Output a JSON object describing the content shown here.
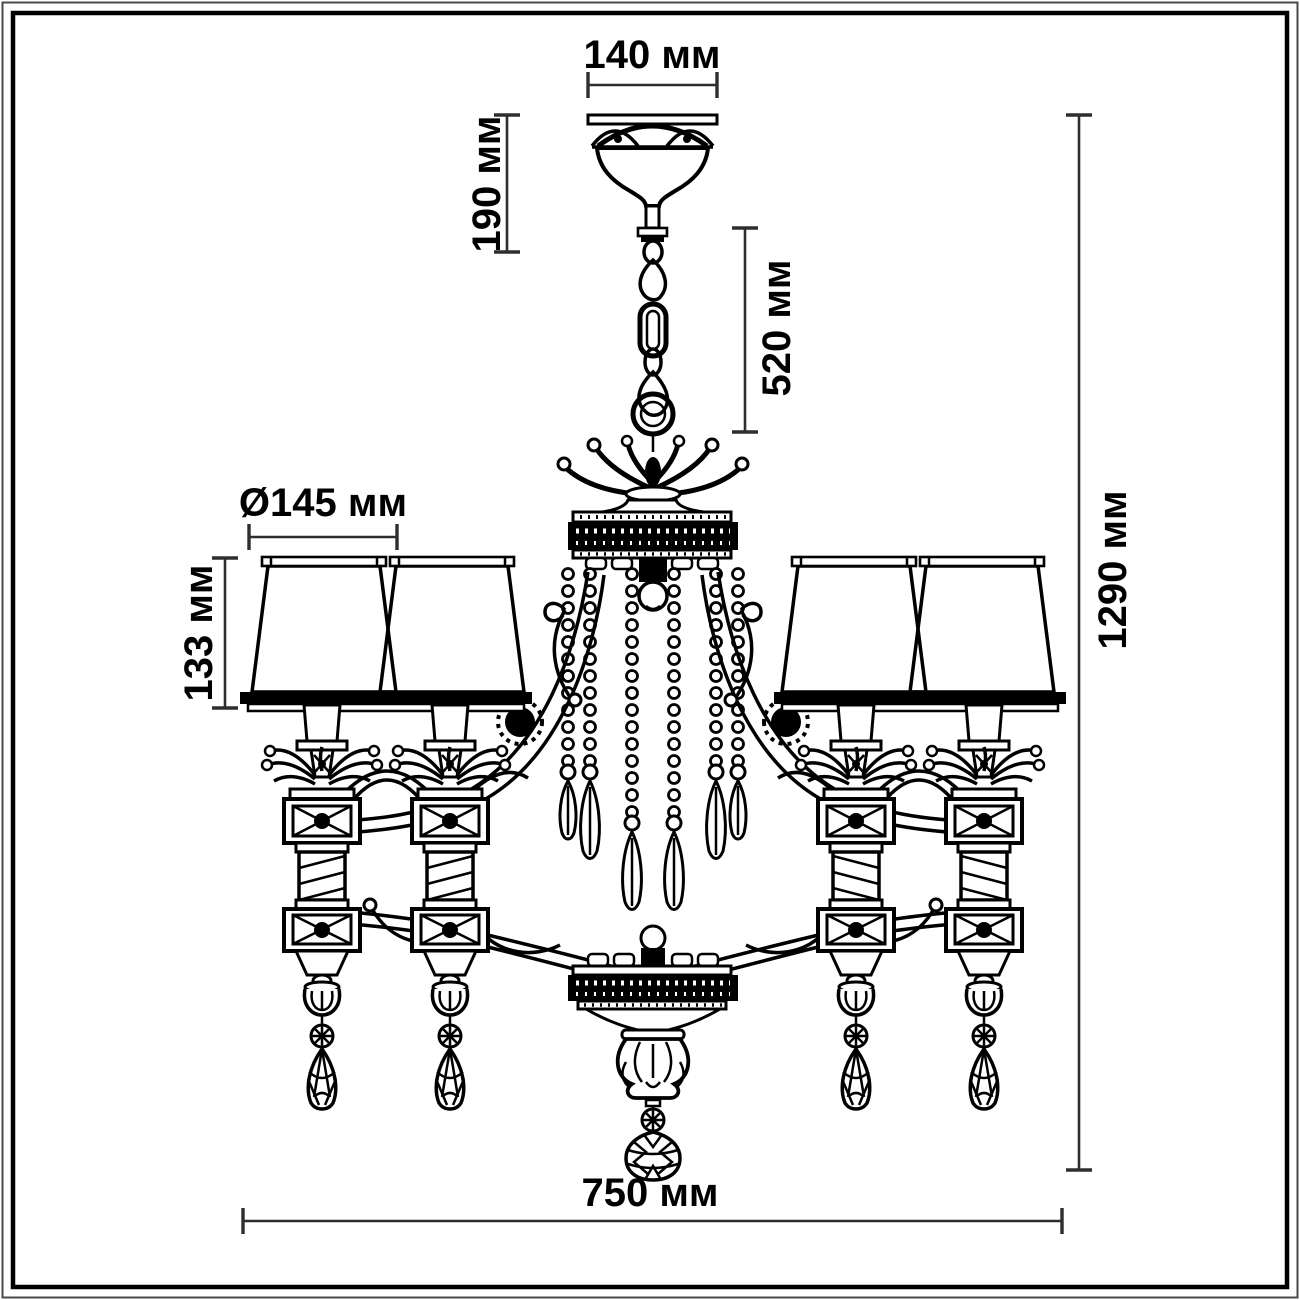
{
  "drawing": {
    "subject": "chandelier-line-drawing",
    "style": "technical dimension drawing, black line art on white, double rectangular frame",
    "background": "#ffffff",
    "line_color": "#000000",
    "visible_shades": 4,
    "visible_arms": 4
  },
  "dims": {
    "canopy_width": {
      "label": "140 мм",
      "value_mm": 140,
      "orientation": "horizontal"
    },
    "canopy_height": {
      "label": "190 мм",
      "value_mm": 190,
      "orientation": "vertical"
    },
    "chain_drop": {
      "label": "520 мм",
      "value_mm": 520,
      "orientation": "vertical"
    },
    "shade_diameter": {
      "label": "Ø145 мм",
      "value_mm": 145,
      "orientation": "horizontal"
    },
    "shade_height": {
      "label": "133 мм",
      "value_mm": 133,
      "orientation": "vertical"
    },
    "total_height": {
      "label": "1290 мм",
      "value_mm": 1290,
      "orientation": "vertical"
    },
    "total_width": {
      "label": "750 мм",
      "value_mm": 750,
      "orientation": "horizontal"
    }
  }
}
